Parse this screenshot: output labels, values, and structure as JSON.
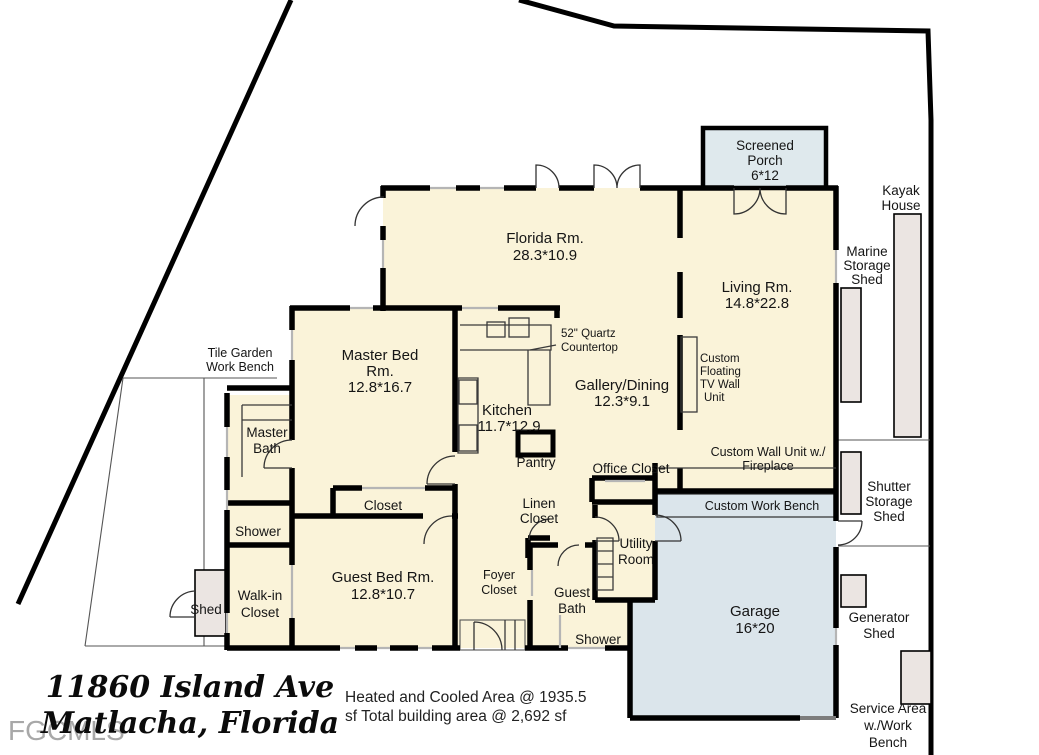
{
  "palette": {
    "cream": "#FAF3D9",
    "garage_blue": "#DBE5EB",
    "porch_blue": "#DFE9ED",
    "shed_gray": "#EBE5E2",
    "wall_black": "#000000",
    "watermark_gray": "#9A9A9A"
  },
  "watermark": {
    "text": "FGCMLS"
  },
  "footer": {
    "address_line1": "11860 Island Ave",
    "address_line2": "Matlacha, Florida",
    "area_line1": "Heated and Cooled Area @ 1935.5",
    "area_line2": "sf  Total building area @ 2,692 sf"
  },
  "rooms": {
    "screened_porch": {
      "lines": [
        "Screened",
        "Porch",
        "6*12"
      ]
    },
    "kayak_house": {
      "lines": [
        "Kayak",
        "House"
      ]
    },
    "florida_room": {
      "lines": [
        "Florida Rm.",
        "28.3*10.9"
      ]
    },
    "living_room": {
      "lines": [
        "Living Rm.",
        "14.8*22.8"
      ]
    },
    "marine_storage_shed": {
      "lines": [
        "Marine",
        "Storage",
        "Shed"
      ]
    },
    "master_bed": {
      "lines": [
        "Master Bed",
        "Rm.",
        "12.8*16.7"
      ]
    },
    "quartz_countertop": {
      "lines": [
        "52\" Quartz",
        "Countertop"
      ]
    },
    "gallery_dining": {
      "lines": [
        "Gallery/Dining",
        "12.3*9.1"
      ]
    },
    "kitchen": {
      "lines": [
        "Kitchen",
        "11.7*12.9"
      ]
    },
    "tv_wall_unit": {
      "lines": [
        "Custom",
        "Floating",
        "TV Wall",
        "Unit"
      ]
    },
    "tile_garden_bench": {
      "lines": [
        "Tile Garden",
        "Work Bench"
      ]
    },
    "master_bath": {
      "lines": [
        "Master",
        "Bath"
      ]
    },
    "pantry": {
      "lines": [
        "Pantry"
      ]
    },
    "office_closet": {
      "lines": [
        "Office Closet"
      ]
    },
    "fireplace_unit": {
      "lines": [
        "Custom Wall Unit w./",
        "Fireplace"
      ]
    },
    "shutter_shed": {
      "lines": [
        "Shutter",
        "Storage",
        "Shed"
      ]
    },
    "closet": {
      "lines": [
        "Closet"
      ]
    },
    "linen_closet": {
      "lines": [
        "Linen",
        "Closet"
      ]
    },
    "master_shower": {
      "lines": [
        "Shower"
      ]
    },
    "work_bench": {
      "lines": [
        "Custom Work Bench"
      ]
    },
    "utility_room": {
      "lines": [
        "Utility",
        "Room"
      ]
    },
    "guest_bed": {
      "lines": [
        "Guest Bed Rm.",
        "12.8*10.7"
      ]
    },
    "foyer_closet": {
      "lines": [
        "Foyer",
        "Closet"
      ]
    },
    "guest_bath": {
      "lines": [
        "Guest",
        "Bath"
      ]
    },
    "walkin_closet": {
      "lines": [
        "Walk-in",
        "Closet"
      ]
    },
    "shed": {
      "lines": [
        "Shed"
      ]
    },
    "garage": {
      "lines": [
        "Garage",
        "16*20"
      ]
    },
    "generator_shed": {
      "lines": [
        "Generator",
        "Shed"
      ]
    },
    "guest_shower": {
      "lines": [
        "Shower"
      ]
    },
    "service_area": {
      "lines": [
        "Service Area",
        "w./Work",
        "Bench"
      ]
    }
  }
}
